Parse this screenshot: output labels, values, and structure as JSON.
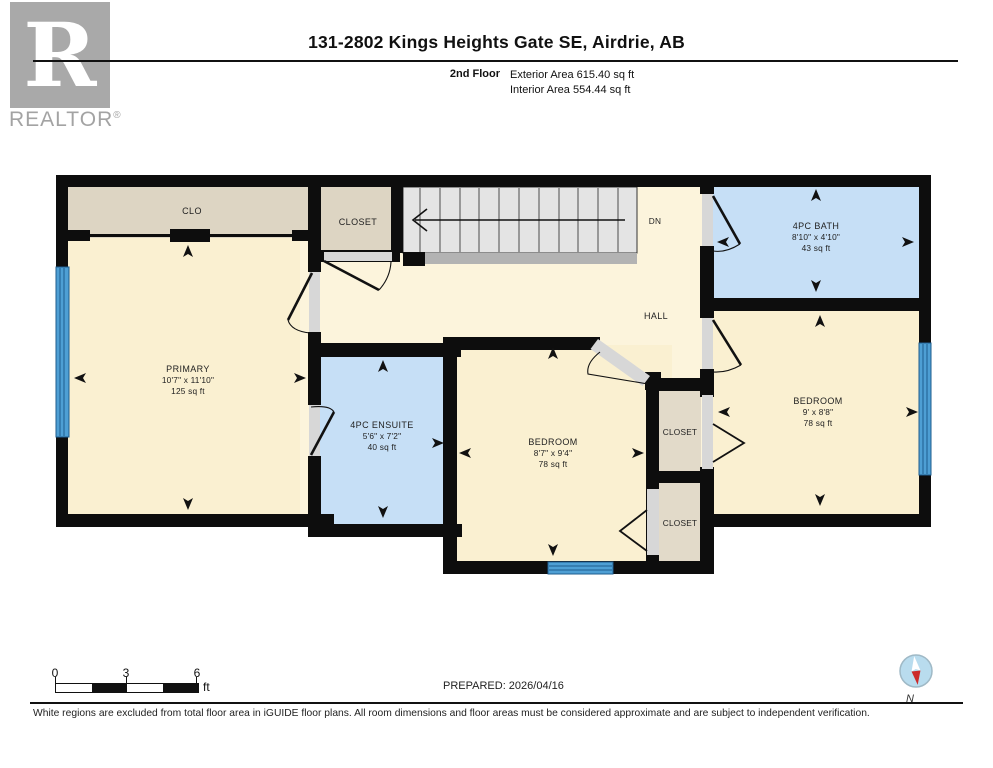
{
  "header": {
    "logo": {
      "letter": "R",
      "brand": "REALTOR",
      "registered": "®"
    },
    "title": "131-2802 Kings Heights Gate SE, Airdrie, AB",
    "floor_label": "2nd Floor",
    "exterior_area": "Exterior Area 615.40 sq ft",
    "interior_area": "Interior Area 554.44 sq ft"
  },
  "floorplan": {
    "rooms": {
      "clo": {
        "name": "CLO"
      },
      "closet_top": {
        "name": "CLOSET"
      },
      "primary": {
        "name": "PRIMARY",
        "dims": "10'7\" x 11'10\"",
        "area": "125 sq ft"
      },
      "ensuite": {
        "name": "4PC ENSUITE",
        "dims": "5'6\" x 7'2\"",
        "area": "40 sq ft"
      },
      "bath": {
        "name": "4PC BATH",
        "dims": "8'10\" x 4'10\"",
        "area": "43 sq ft"
      },
      "bedroom_center": {
        "name": "BEDROOM",
        "dims": "8'7\" x 9'4\"",
        "area": "78 sq ft"
      },
      "bedroom_right": {
        "name": "BEDROOM",
        "dims": "9' x 8'8\"",
        "area": "78 sq ft"
      },
      "closet_mid": {
        "name": "CLOSET"
      },
      "closet_bottom": {
        "name": "CLOSET"
      },
      "hall": {
        "name": "HALL"
      },
      "stairs": {
        "label": "DN"
      }
    },
    "colors": {
      "wall": "#0d0d0d",
      "room_cream": "#faf0d1",
      "hall_cream": "#fcf4dc",
      "closet_beige": "#ddd5c3",
      "bath_blue": "#c6dff6",
      "window_blue": "#4e9fd4",
      "stair_gray": "#e4e4e4",
      "compass_red": "#cc2a2a"
    }
  },
  "footer": {
    "scale": {
      "ticks": [
        "0",
        "3",
        "6"
      ],
      "unit": "ft"
    },
    "prepared": "PREPARED: 2026/04/16",
    "compass_label": "N",
    "disclaimer": "White regions are excluded from total floor area in iGUIDE floor plans. All room dimensions and floor areas must be considered approximate and are subject to independent verification."
  }
}
